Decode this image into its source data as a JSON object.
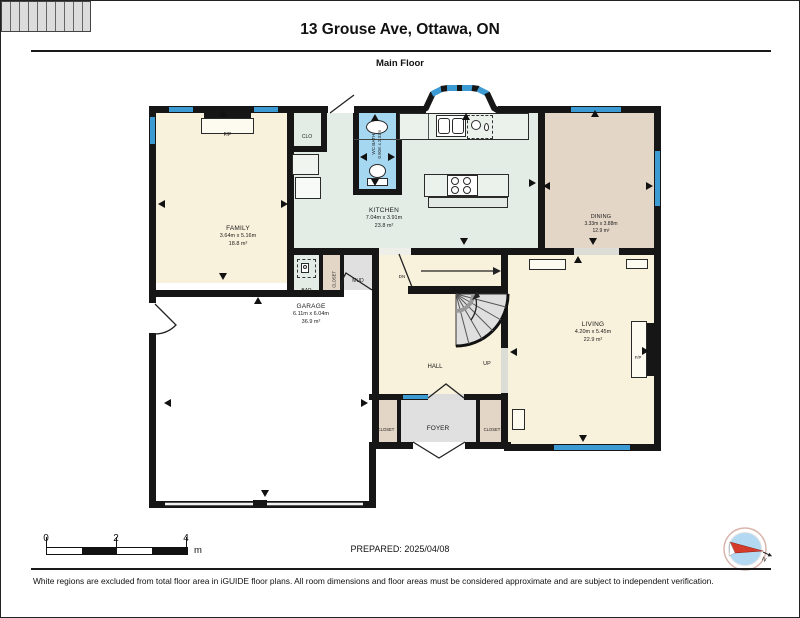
{
  "header": {
    "title": "13 Grouse Ave, Ottawa, ON",
    "subtitle": "Main Floor"
  },
  "rooms": {
    "family": {
      "name": "FAMILY",
      "dims": "3.64m x 5.16m",
      "area": "18.8 m²"
    },
    "kitchen": {
      "name": "KITCHEN",
      "dims": "7.04m x 3.91m",
      "area": "23.8 m²"
    },
    "dining": {
      "name": "DINING",
      "dims": "3.33m x 3.88m",
      "area": "12.9 m²"
    },
    "living": {
      "name": "LIVING",
      "dims": "4.20m x 5.45m",
      "area": "22.9 m²"
    },
    "garage": {
      "name": "GARAGE",
      "dims": "6.11m x 6.04m",
      "area": "36.9 m²"
    },
    "wc_bath": {
      "name": "WC BATH",
      "dims": "0.90m x 2.31m"
    },
    "hall": {
      "name": "HALL"
    },
    "foyer": {
      "name": "FOYER"
    },
    "mud": {
      "name": "MUD"
    },
    "bar": {
      "name": "BAR"
    },
    "clo": {
      "name": "CLO"
    },
    "closet": {
      "name": "CLOSET"
    },
    "closet_left": {
      "name": "CLOSET"
    },
    "closet_right": {
      "name": "CLOSET"
    }
  },
  "labels": {
    "fireplace": "F/P",
    "stairs_down": "DN",
    "stairs_up": "UP",
    "north": "N"
  },
  "scale_bar": {
    "ticks": [
      "0",
      "2",
      "4"
    ],
    "unit": "m"
  },
  "prepared_label": "PREPARED: 2025/04/08",
  "disclaimer": "White regions are excluded from total floor area in iGUIDE floor plans. All room dimensions and floor areas must be considered approximate and are subject to independent verification.",
  "colors": {
    "wall": "#161616",
    "window": "#3D9BD4",
    "room_cream": "#F8F1DB",
    "room_green": "#E3EDE5",
    "room_tan": "#E4D6C6",
    "room_blue": "#A6D7F0",
    "room_gray": "#E0E0E0",
    "compass_fill": "#B3D9F2",
    "needle_red": "#D43B2A"
  }
}
